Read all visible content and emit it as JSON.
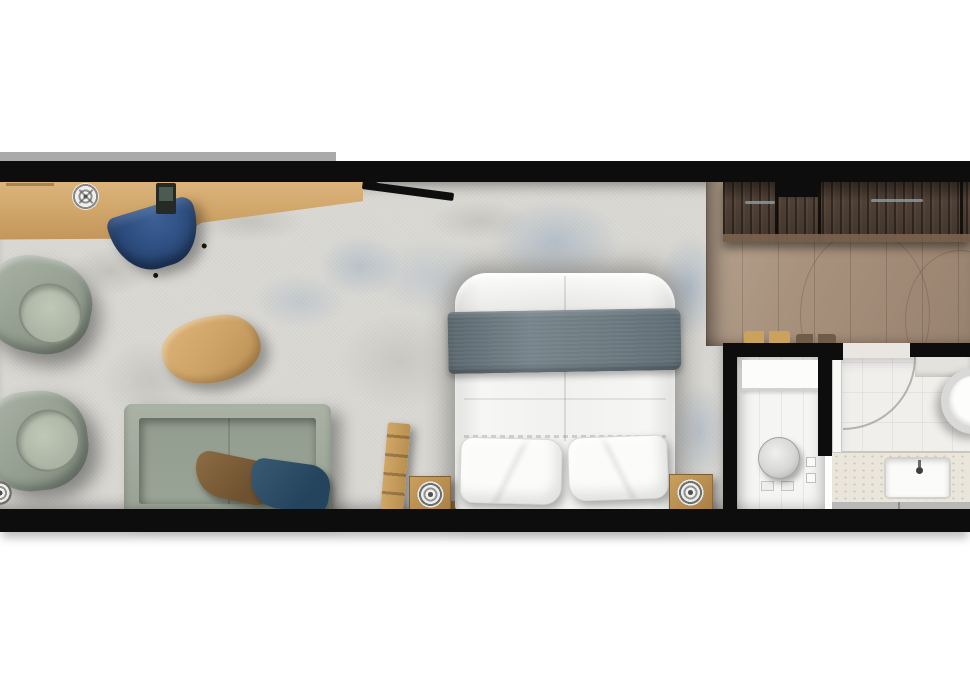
{
  "scene": {
    "title": "Hotel guest room floor plan, top-down rendered view",
    "rooms": {
      "living": "Bedroom and living area with rug",
      "hallway": "Entry hallway with wardrobe",
      "wc": "Shower and WC room",
      "bath": "Bathroom with vanity and basin"
    },
    "furniture": [
      "desk",
      "desk-chair",
      "wall-tv",
      "ceiling-spotlight",
      "lounge-chair-upper",
      "lounge-chair-lower",
      "coffee-table",
      "sofa",
      "sofa-pillow-brown",
      "sofa-pillow-navy",
      "double-bed",
      "bed-blanket",
      "bed-pillows",
      "nightstand-left",
      "nightstand-right",
      "ceiling-speakers",
      "luggage-rack",
      "wardrobe",
      "slippers",
      "toilet-fixture",
      "shower-door",
      "vanity-sink",
      "round-basin"
    ]
  },
  "colors": {
    "wall": "#0d0d0d",
    "ledge": "#9b9b9b",
    "carpet": "#d9d8d3",
    "carpet-blue": "#8fa5bd",
    "desk-wood": "#cfa468",
    "table-wood": "#cda266",
    "floor-wood": "#a8927e",
    "wardrobe-wood": "#58483d",
    "sage": "#8e998b",
    "sage-light": "#c0c7b6",
    "chair-navy": "#2b4a7b",
    "pillow-brown": "#6d5130",
    "pillow-navy": "#24445e",
    "blanket": "#76838a",
    "bed-white": "#f1f1ef",
    "tile": "#f1efec",
    "counter": "#eae6db",
    "cabinet": "#b8b8b6"
  }
}
